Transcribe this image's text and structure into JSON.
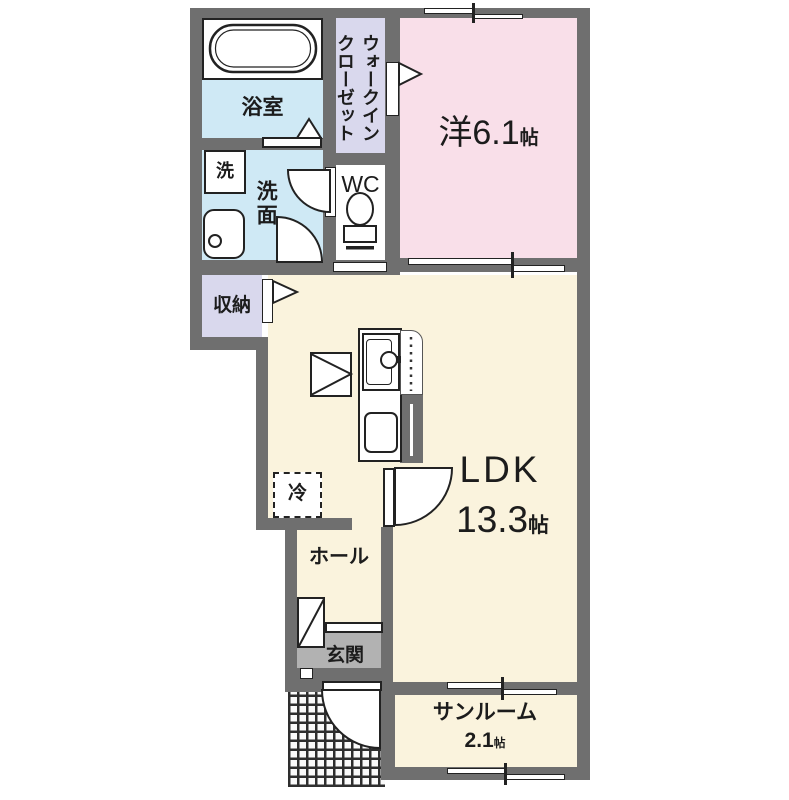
{
  "floorplan": {
    "rooms": {
      "bathroom": {
        "label": "浴室"
      },
      "washer": {
        "label": "洗"
      },
      "washroom": {
        "label": "洗面"
      },
      "walk_in_closet": {
        "label_line1": "ウォークイン",
        "label_line2": "クローゼット"
      },
      "wc": {
        "label": "WC"
      },
      "western_room": {
        "label": "洋",
        "size": "6.1",
        "unit": "帖"
      },
      "storage": {
        "label": "収納"
      },
      "ldk": {
        "label": "LDK",
        "size": "13.3",
        "unit": "帖"
      },
      "fridge": {
        "label": "冷"
      },
      "hall": {
        "label": "ホール"
      },
      "entrance": {
        "label": "玄関"
      },
      "sunroom": {
        "label": "サンルーム",
        "size": "2.1",
        "unit": "帖"
      }
    },
    "colors": {
      "wall": "#6f6f6f",
      "western_room": "#f9dfe9",
      "ldk": "#faf3dd",
      "water_area": "#cfe9f5",
      "closet": "#d9d8ed",
      "entrance": "#b2b2b2",
      "line": "#222222"
    }
  }
}
